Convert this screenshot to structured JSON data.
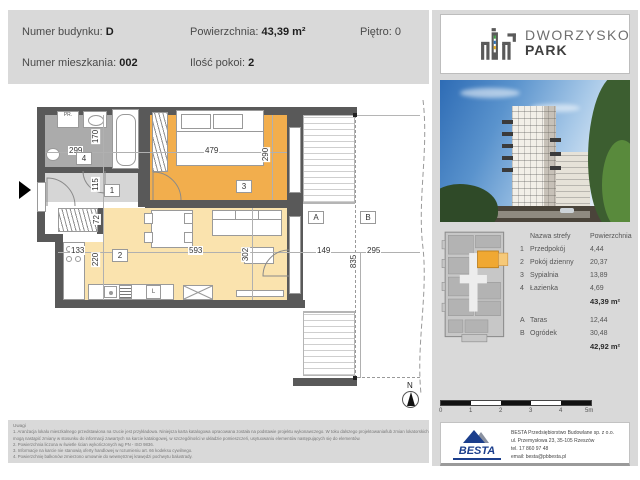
{
  "header": {
    "building_label": "Numer budynku:",
    "building_value": "D",
    "area_label": "Powierzchnia:",
    "area_value": "43,39",
    "area_unit": "m²",
    "floor_label": "Piętro:",
    "floor_value": "0",
    "apartment_label": "Numer mieszkania:",
    "apartment_value": "002",
    "rooms_label": "Ilość pokoi:",
    "rooms_value": "2"
  },
  "brand": {
    "line1": "DWORZYSKO",
    "line2": "PARK"
  },
  "plan": {
    "rooms": {
      "hall": "1",
      "living": "2",
      "bedroom": "3",
      "bath": "4",
      "terrace": "A",
      "garden": "B"
    },
    "dims": {
      "bath_w": "299",
      "bath_h": "170",
      "hall_h": "115",
      "wardrobe_h": "72",
      "kitchen_w": "133",
      "kitchen_h": "220",
      "bedroom_w": "479",
      "bedroom_h": "290",
      "living_w": "593",
      "living_h": "302",
      "terrace_w": "149",
      "garden_w": "295",
      "garden_h": "835"
    },
    "furniture": {
      "washer": "PR.",
      "fridge": "L"
    },
    "north": "N"
  },
  "legend": {
    "col_zone": "Nazwa strefy",
    "col_area": "Powierzchnia",
    "rows": [
      {
        "num": "1",
        "name": "Przedpokój",
        "area": "4,44"
      },
      {
        "num": "2",
        "name": "Pokój dzienny",
        "area": "20,37"
      },
      {
        "num": "3",
        "name": "Sypialnia",
        "area": "13,89"
      },
      {
        "num": "4",
        "name": "Łazienka",
        "area": "4,69"
      }
    ],
    "total_inside": "43,39 m²",
    "rows_outdoor": [
      {
        "num": "A",
        "name": "Taras",
        "area": "12,44"
      },
      {
        "num": "B",
        "name": "Ogródek",
        "area": "30,48"
      }
    ],
    "total_outdoor": "42,92 m²"
  },
  "scalebar": {
    "labels": [
      "0",
      "1",
      "2",
      "3",
      "4",
      "5m"
    ]
  },
  "notes": {
    "title": "Uwagi",
    "lines": [
      "1. Aranżacja lokalu mieszkalnego przedstawiona na rzucie jest przykładowa. Niniejsza karta katalogowa opracowana została na podstawie projektu wykonawczego. W toku dalszego projektowania/lub zmian lokatorskich",
      "mogą nastąpić zmiany w stosunku do informacji zawartych na karcie katalogowej, w szczególności w układzie pomieszczeń, usytuowaniu elementów następujących się do elementów.",
      "2. Powierzchnia liczona w świetle ścian wykończonych wg PN - ISO 9836.",
      "3. Informacje na karcie nie stanowią oferty handlowej w rozumieniu art. 66 kodeksu cywilnego.",
      "4. Powierzchnię balkonów zmierzono umownie do wewnętrznej krawędzi pochwytu balustrady."
    ]
  },
  "developer": {
    "name": "BESTA",
    "lines": [
      "BESTA Przedsiębiorstwo Budowlane sp. z o.o.",
      "ul. Przemysłowa 23, 35-105 Rzeszów",
      "tel. 17 860 97 48",
      "email: besta@pbbesta.pl"
    ]
  },
  "colors": {
    "wall": "#595959",
    "bedroom": "#F2AE4D",
    "living": "#FAE3AE",
    "accent": "#F0A832",
    "brand_blue": "#1B3E8C"
  }
}
